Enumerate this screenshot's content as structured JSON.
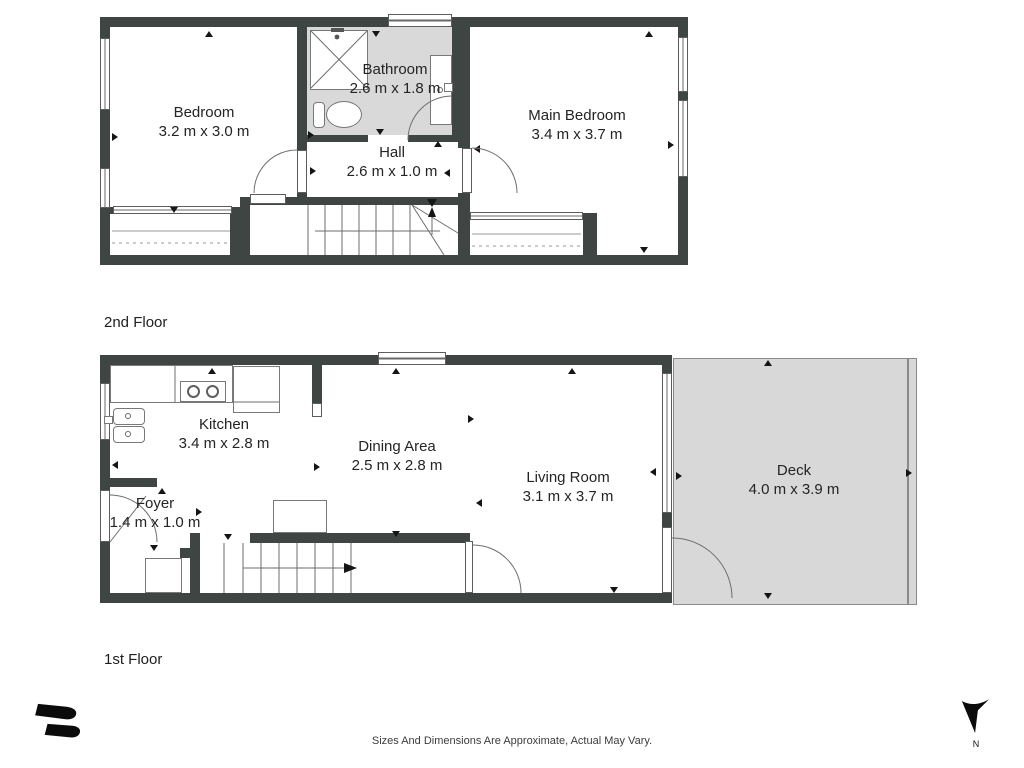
{
  "floors": [
    {
      "label": "2nd Floor",
      "rooms": [
        {
          "name": "Bedroom",
          "dims": "3.2 m x 3.0 m"
        },
        {
          "name": "Bathroom",
          "dims": "2.6 m x 1.8 m"
        },
        {
          "name": "Main Bedroom",
          "dims": "3.4 m x 3.7 m"
        },
        {
          "name": "Hall",
          "dims": "2.6 m x 1.0 m"
        }
      ]
    },
    {
      "label": "1st Floor",
      "rooms": [
        {
          "name": "Kitchen",
          "dims": "3.4 m x 2.8 m"
        },
        {
          "name": "Dining Area",
          "dims": "2.5 m x 2.8 m"
        },
        {
          "name": "Living Room",
          "dims": "3.1 m x 3.7 m"
        },
        {
          "name": "Foyer",
          "dims": "1.4 m x 1.0 m"
        },
        {
          "name": "Deck",
          "dims": "4.0 m x 3.9 m"
        }
      ]
    }
  ],
  "footer": {
    "disclaimer": "Sizes And Dimensions Are Approximate, Actual May Vary."
  },
  "compass": {
    "label": "N"
  },
  "colors": {
    "wall": "#3f4542",
    "shaded_area": "#d9d9d9",
    "thin_line": "#6e6e6e",
    "text": "#242424"
  }
}
